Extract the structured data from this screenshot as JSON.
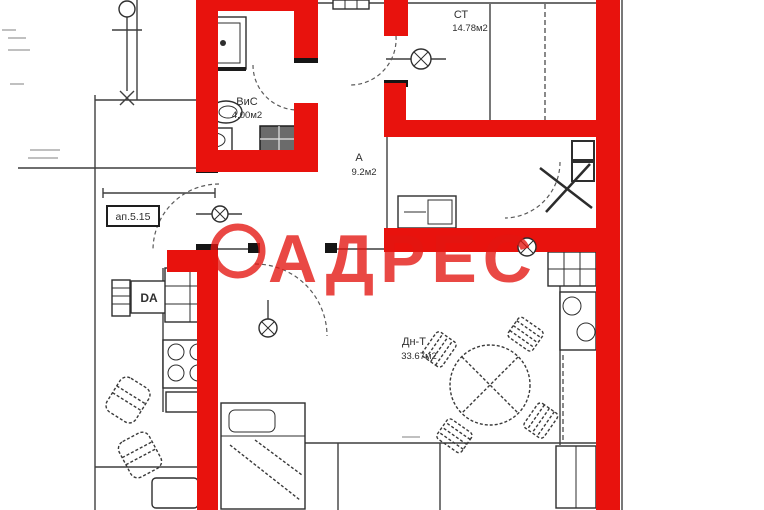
{
  "watermark": {
    "text": "АДРЕС"
  },
  "unit_label": "ап.5.15",
  "rooms": {
    "bathroom": {
      "name": "ВиС",
      "area": "4.00м2"
    },
    "room_st": {
      "name": "СТ",
      "area": "14.78м2"
    },
    "hall": {
      "name": "А",
      "area": "9.2м2"
    },
    "living": {
      "name": "Дн-Т",
      "area": "33.67м2"
    }
  },
  "appliance_label": "DA",
  "colors": {
    "highlight_wall": "#e8120d",
    "watermark": "#e41510",
    "ink": "#2f2f2f",
    "background": "#ffffff"
  }
}
